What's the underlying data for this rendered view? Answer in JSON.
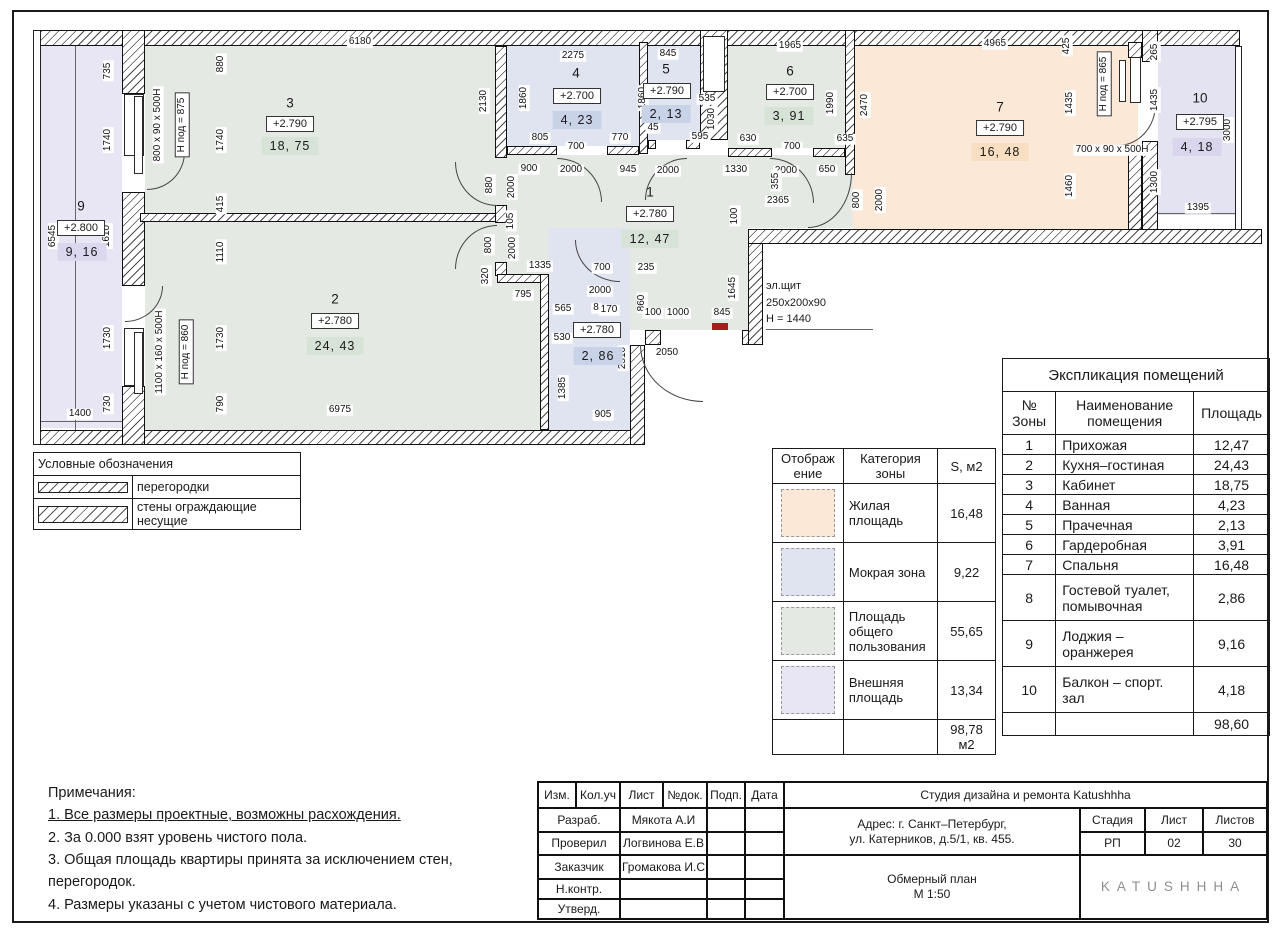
{
  "colors": {
    "living": "#FBE8D6",
    "wet": "#DFE4F0",
    "common": "#E4EAE3",
    "external": "#E8E6F4",
    "external2": "#E4E3F1",
    "badge_common": "#D7E3D6",
    "badge_wet": "#C9D3E7",
    "badge_living": "#F8DFC2",
    "badge_external": "#DBD7EE",
    "badge_external2": "#D8D5EC",
    "red_mark": "#A61C1C"
  },
  "plan": {
    "rooms": [
      {
        "id": "1",
        "num": "1",
        "elev": "+2.780",
        "area": "12, 47",
        "cat": "common",
        "nx": 650,
        "ny": 192,
        "ex": 650,
        "ey": 214,
        "ax": 650,
        "ay": 239
      },
      {
        "id": "2",
        "num": "2",
        "elev": "+2.780",
        "area": "24, 43",
        "cat": "common",
        "nx": 335,
        "ny": 299,
        "ex": 335,
        "ey": 321,
        "ax": 335,
        "ay": 346
      },
      {
        "id": "3",
        "num": "3",
        "elev": "+2.790",
        "area": "18, 75",
        "cat": "common",
        "nx": 290,
        "ny": 103,
        "ex": 290,
        "ey": 124,
        "ax": 290,
        "ay": 146
      },
      {
        "id": "4",
        "num": "4",
        "elev": "+2.700",
        "area": "4, 23",
        "cat": "wet",
        "nx": 576,
        "ny": 73,
        "ex": 577,
        "ey": 96,
        "ax": 577,
        "ay": 120
      },
      {
        "id": "5",
        "num": "5",
        "elev": "+2.790",
        "area": "2, 13",
        "cat": "wet",
        "nx": 666,
        "ny": 69,
        "ex": 667,
        "ey": 91,
        "ax": 666,
        "ay": 114
      },
      {
        "id": "6",
        "num": "6",
        "elev": "+2.700",
        "area": "3, 91",
        "cat": "common",
        "nx": 790,
        "ny": 71,
        "ex": 790,
        "ey": 92,
        "ax": 789,
        "ay": 116
      },
      {
        "id": "7",
        "num": "7",
        "elev": "+2.790",
        "area": "16, 48",
        "cat": "living",
        "nx": 1000,
        "ny": 107,
        "ex": 1000,
        "ey": 128,
        "ax": 1000,
        "ay": 152
      },
      {
        "id": "8",
        "num": "",
        "elev": "+2.780",
        "area": "2, 86",
        "cat": "wet",
        "nx": 0,
        "ny": 0,
        "ex": 597,
        "ey": 330,
        "ax": 598,
        "ay": 356
      },
      {
        "id": "9",
        "num": "9",
        "elev": "+2.800",
        "area": "9, 16",
        "cat": "external",
        "nx": 81,
        "ny": 206,
        "ex": 81,
        "ey": 228,
        "ax": 82,
        "ay": 252
      },
      {
        "id": "10",
        "num": "10",
        "elev": "+2.795",
        "area": "4, 18",
        "cat": "external2",
        "nx": 1200,
        "ny": 98,
        "ex": 1200,
        "ey": 122,
        "ax": 1197,
        "ay": 147
      }
    ],
    "dims": [
      {
        "t": "6180",
        "x": 360,
        "y": 42
      },
      {
        "t": "880",
        "x": 221,
        "y": 64,
        "r": 1
      },
      {
        "t": "735",
        "x": 108,
        "y": 71,
        "r": 1
      },
      {
        "t": "1740",
        "x": 108,
        "y": 140,
        "r": 1
      },
      {
        "t": "1740",
        "x": 221,
        "y": 140,
        "r": 1
      },
      {
        "t": "415",
        "x": 221,
        "y": 204,
        "r": 1
      },
      {
        "t": "6545",
        "x": 53,
        "y": 236,
        "r": 1
      },
      {
        "t": "1610",
        "x": 107,
        "y": 236,
        "r": 1
      },
      {
        "t": "1110",
        "x": 221,
        "y": 252,
        "r": 1
      },
      {
        "t": "1730",
        "x": 108,
        "y": 338,
        "r": 1
      },
      {
        "t": "1730",
        "x": 221,
        "y": 338,
        "r": 1
      },
      {
        "t": "730",
        "x": 108,
        "y": 404,
        "r": 1
      },
      {
        "t": "790",
        "x": 221,
        "y": 404,
        "r": 1
      },
      {
        "t": "1400",
        "x": 80,
        "y": 414
      },
      {
        "t": "6975",
        "x": 340,
        "y": 410
      },
      {
        "t": "800 x 90 x 500H",
        "x": 158,
        "y": 125,
        "r": 1
      },
      {
        "t": "Н под = 875",
        "x": 182,
        "y": 125,
        "r": 1,
        "b": 1
      },
      {
        "t": "1100 x 160 x 500H",
        "x": 160,
        "y": 352,
        "r": 1
      },
      {
        "t": "Н под = 860",
        "x": 186,
        "y": 352,
        "r": 1,
        "b": 1
      },
      {
        "t": "2130",
        "x": 484,
        "y": 101,
        "r": 1
      },
      {
        "t": "2275",
        "x": 573,
        "y": 56
      },
      {
        "t": "1860",
        "x": 524,
        "y": 98,
        "r": 1
      },
      {
        "t": "1860",
        "x": 643,
        "y": 98,
        "r": 1
      },
      {
        "t": "805",
        "x": 540,
        "y": 138
      },
      {
        "t": "700",
        "x": 576,
        "y": 147
      },
      {
        "t": "770",
        "x": 620,
        "y": 138
      },
      {
        "t": "845",
        "x": 668,
        "y": 54
      },
      {
        "t": "535",
        "x": 707,
        "y": 99
      },
      {
        "t": "1030",
        "x": 712,
        "y": 119,
        "r": 1
      },
      {
        "t": "595",
        "x": 700,
        "y": 137
      },
      {
        "t": "45",
        "x": 653,
        "y": 128
      },
      {
        "t": "1965",
        "x": 790,
        "y": 46
      },
      {
        "t": "1990",
        "x": 831,
        "y": 103,
        "r": 1
      },
      {
        "t": "630",
        "x": 748,
        "y": 139
      },
      {
        "t": "700",
        "x": 792,
        "y": 147
      },
      {
        "t": "635",
        "x": 845,
        "y": 139
      },
      {
        "t": "900",
        "x": 529,
        "y": 169
      },
      {
        "t": "2000",
        "x": 571,
        "y": 170
      },
      {
        "t": "945",
        "x": 628,
        "y": 170
      },
      {
        "t": "2000",
        "x": 668,
        "y": 171
      },
      {
        "t": "1330",
        "x": 736,
        "y": 170
      },
      {
        "t": "2000",
        "x": 786,
        "y": 171
      },
      {
        "t": "650",
        "x": 827,
        "y": 170
      },
      {
        "t": "355",
        "x": 776,
        "y": 181,
        "r": 1
      },
      {
        "t": "800",
        "x": 857,
        "y": 200,
        "r": 1
      },
      {
        "t": "2000",
        "x": 880,
        "y": 200,
        "r": 1
      },
      {
        "t": "4965",
        "x": 995,
        "y": 44
      },
      {
        "t": "2470",
        "x": 865,
        "y": 105,
        "r": 1
      },
      {
        "t": "425",
        "x": 1067,
        "y": 46,
        "r": 1
      },
      {
        "t": "1435",
        "x": 1070,
        "y": 103,
        "r": 1
      },
      {
        "t": "Н под = 865",
        "x": 1104,
        "y": 84,
        "r": 1,
        "b": 1
      },
      {
        "t": "1460",
        "x": 1070,
        "y": 186,
        "r": 1
      },
      {
        "t": "700 x 90 x 500Н",
        "x": 1112,
        "y": 150
      },
      {
        "t": "265",
        "x": 1155,
        "y": 52,
        "r": 1
      },
      {
        "t": "1435",
        "x": 1155,
        "y": 100,
        "r": 1
      },
      {
        "t": "1300",
        "x": 1155,
        "y": 182,
        "r": 1
      },
      {
        "t": "3000",
        "x": 1228,
        "y": 130,
        "r": 1
      },
      {
        "t": "1395",
        "x": 1198,
        "y": 208
      },
      {
        "t": "2365",
        "x": 778,
        "y": 201
      },
      {
        "t": "100",
        "x": 735,
        "y": 216,
        "r": 1
      },
      {
        "t": "1645",
        "x": 733,
        "y": 288,
        "r": 1
      },
      {
        "t": "880",
        "x": 490,
        "y": 185,
        "r": 1
      },
      {
        "t": "2000",
        "x": 512,
        "y": 187,
        "r": 1
      },
      {
        "t": "105",
        "x": 511,
        "y": 221,
        "r": 1
      },
      {
        "t": "800",
        "x": 489,
        "y": 245,
        "r": 1
      },
      {
        "t": "2000",
        "x": 513,
        "y": 248,
        "r": 1
      },
      {
        "t": "320",
        "x": 486,
        "y": 276,
        "r": 1
      },
      {
        "t": "1335",
        "x": 540,
        "y": 266
      },
      {
        "t": "795",
        "x": 523,
        "y": 295
      },
      {
        "t": "700",
        "x": 602,
        "y": 268
      },
      {
        "t": "235",
        "x": 646,
        "y": 268
      },
      {
        "t": "2000",
        "x": 600,
        "y": 291
      },
      {
        "t": "860",
        "x": 642,
        "y": 303,
        "r": 1
      },
      {
        "t": "565",
        "x": 563,
        "y": 309
      },
      {
        "t": "8",
        "x": 596,
        "y": 308
      },
      {
        "t": "170",
        "x": 609,
        "y": 310
      },
      {
        "t": "530",
        "x": 562,
        "y": 338
      },
      {
        "t": "2510",
        "x": 623,
        "y": 358,
        "r": 1
      },
      {
        "t": "1385",
        "x": 563,
        "y": 388,
        "r": 1
      },
      {
        "t": "905",
        "x": 603,
        "y": 415
      },
      {
        "t": "2050",
        "x": 667,
        "y": 353
      },
      {
        "t": "100",
        "x": 653,
        "y": 313
      },
      {
        "t": "1000",
        "x": 678,
        "y": 313
      },
      {
        "t": "845",
        "x": 722,
        "y": 313
      }
    ],
    "el_shield": [
      "эл.щит",
      "250x200x90",
      "Н = 1440"
    ]
  },
  "legend": {
    "title": "Условные обозначения",
    "items": [
      {
        "label": "перегородки"
      },
      {
        "label": "стены ограждающие несущие"
      }
    ]
  },
  "zone_table": {
    "headers": [
      "Отображ ение",
      "Категория зоны",
      "S, м2"
    ],
    "rows": [
      {
        "cat": "living",
        "label": "Жилая площадь",
        "s": "16,48"
      },
      {
        "cat": "wet",
        "label": "Мокрая зона",
        "s": "9,22"
      },
      {
        "cat": "common",
        "label": "Площадь общего пользования",
        "s": "55,65"
      },
      {
        "cat": "external",
        "label": "Внешняя площадь",
        "s": "13,34"
      }
    ],
    "total": "98,78 м2"
  },
  "explication": {
    "title": "Экспликация помещений",
    "headers": [
      "№ Зоны",
      "Наименование помещения",
      "Площадь"
    ],
    "rows": [
      {
        "n": "1",
        "name": "Прихожая",
        "s": "12,47"
      },
      {
        "n": "2",
        "name": "Кухня–гостиная",
        "s": "24,43"
      },
      {
        "n": "3",
        "name": "Кабинет",
        "s": "18,75"
      },
      {
        "n": "4",
        "name": "Ванная",
        "s": "4,23"
      },
      {
        "n": "5",
        "name": "Прачечная",
        "s": "2,13"
      },
      {
        "n": "6",
        "name": "Гардеробная",
        "s": "3,91"
      },
      {
        "n": "7",
        "name": "Спальня",
        "s": "16,48"
      },
      {
        "n": "8",
        "name": "Гостевой туалет, помывочная",
        "s": "2,86",
        "tall": true
      },
      {
        "n": "9",
        "name": "Лоджия – оранжерея",
        "s": "9,16",
        "tall": true
      },
      {
        "n": "10",
        "name": "Балкон – спорт. зал",
        "s": "4,18",
        "tall": true
      }
    ],
    "total": "98,60"
  },
  "notes": {
    "title": "Примечания:",
    "items": [
      {
        "text": "1. Все размеры проектные, возможны расхождения.",
        "u": true
      },
      {
        "text": "2. За 0.000 взят уровень чистого пола."
      },
      {
        "text": "3. Общая площадь квартиры принята за исключением стен, перегородок."
      },
      {
        "text": "4. Размеры указаны с учетом чистового материала."
      }
    ]
  },
  "titleblock": {
    "cols": [
      "Изм.",
      "Кол.уч",
      "Лист",
      "№док.",
      "Подп.",
      "Дата"
    ],
    "rows": [
      {
        "label": "Разраб.",
        "name": "Мякота А.И"
      },
      {
        "label": "Проверил",
        "name": "Логвинова Е.В"
      },
      {
        "label": "Заказчик",
        "name": "Громакова И.С"
      },
      {
        "label": "Н.контр.",
        "name": ""
      },
      {
        "label": "Утверд.",
        "name": ""
      }
    ],
    "company": "Студия дизайна и ремонта Katushhha",
    "address1": "Адрес: г. Санкт–Петербург,",
    "address2": "ул. Катерников, д.5/1, кв. 455.",
    "stage_headers": [
      "Стадия",
      "Лист",
      "Листов"
    ],
    "stage_values": [
      "РП",
      "02",
      "30"
    ],
    "doc_title": "Обмерный план",
    "doc_scale": "М 1:50",
    "logo": "KATUSHHHA"
  }
}
